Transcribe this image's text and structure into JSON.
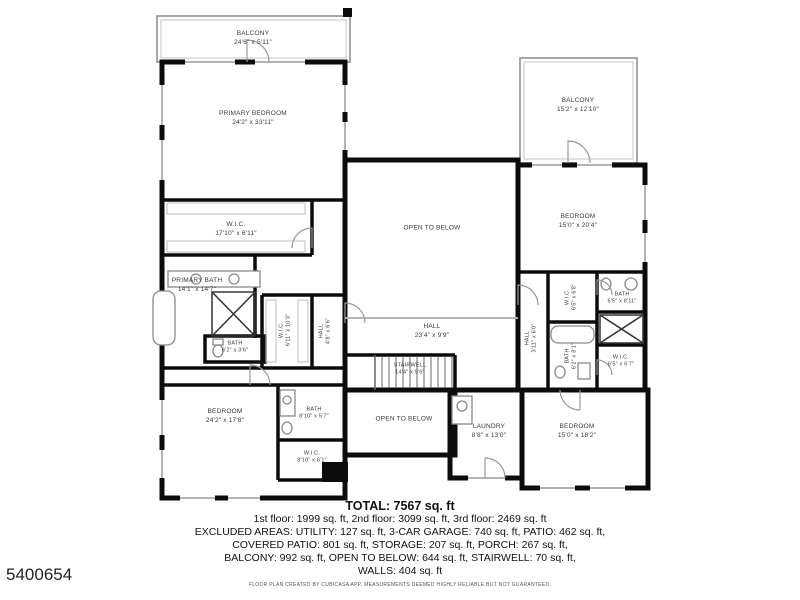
{
  "page": {
    "id_number": "5400654",
    "disclaimer": "FLOOR PLAN CREATED BY CUBICASA APP, MEASUREMENTS DEEMED HIGHLY RELIABLE BUT NOT GUARANTEED."
  },
  "summary": {
    "total": "TOTAL: 7567 sq. ft",
    "lines": [
      "1st floor: 1999 sq. ft, 2nd floor: 3099 sq. ft, 3rd floor: 2469 sq. ft",
      "EXCLUDED AREAS: UTILITY: 127 sq. ft, 3-CAR GARAGE: 740 sq. ft, PATIO: 462 sq. ft,",
      "COVERED PATIO: 801 sq. ft, STORAGE: 207 sq. ft, PORCH: 267 sq. ft,",
      "BALCONY: 992 sq. ft, OPEN TO BELOW: 644 sq. ft, STAIRWELL: 70 sq. ft,",
      "WALLS: 404 sq. ft"
    ]
  },
  "rooms": {
    "balcony_top": {
      "name": "BALCONY",
      "dims": "24'6\" x 5'11\""
    },
    "primary_bedroom": {
      "name": "PRIMARY BEDROOM",
      "dims": "24'2\" x 33'11\""
    },
    "wic_primary": {
      "name": "W.I.C.",
      "dims": "17'10\" x 6'11\""
    },
    "primary_bath": {
      "name": "PRIMARY BATH",
      "dims": "14'1\" x 14'7\""
    },
    "bath_small": {
      "name": "BATH",
      "dims": "6'2\" x 3'6\""
    },
    "wic_left": {
      "name": "W.I.C.",
      "dims": "6'11\" x 10'3\""
    },
    "hall_left": {
      "name": "HALL",
      "dims": "4'8\" x 6'6\""
    },
    "open_below_top": {
      "name": "OPEN TO BELOW"
    },
    "hall_center": {
      "name": "HALL",
      "dims": "23'4\" x 9'9\""
    },
    "hall_right": {
      "name": "HALL",
      "dims": "3'11\" x 6'0\""
    },
    "stairwell": {
      "name": "STAIRWELL",
      "dims": "14'4\" x 5'6\""
    },
    "open_below_bottom": {
      "name": "OPEN TO BELOW"
    },
    "balcony_right": {
      "name": "BALCONY",
      "dims": "15'2\" x 12'10\""
    },
    "bedroom_right_top": {
      "name": "BEDROOM",
      "dims": "15'0\" x 20'4\""
    },
    "wic_right_top": {
      "name": "W.I.C.",
      "dims": "6'5\" x 6'8\""
    },
    "bath_right_top": {
      "name": "BATH",
      "dims": "6'5\" x 8'11\""
    },
    "bath_right_bottom": {
      "name": "BATH",
      "dims": "6'2\" x 8'1\""
    },
    "wic_right_bottom": {
      "name": "W.I.C.",
      "dims": "6'5\" x 6'7\""
    },
    "bedroom_bottom_left": {
      "name": "BEDROOM",
      "dims": "24'2\" x 17'8\""
    },
    "bath_bottom_left": {
      "name": "BATH",
      "dims": "8'10\" x 5'7\""
    },
    "wic_bottom_left": {
      "name": "W.I.C.",
      "dims": "8'10\" x 6'1\""
    },
    "laundry": {
      "name": "LAUNDRY",
      "dims": "8'8\" x 13'0\""
    },
    "bedroom_bottom_right": {
      "name": "BEDROOM",
      "dims": "15'0\" x 18'2\""
    }
  }
}
